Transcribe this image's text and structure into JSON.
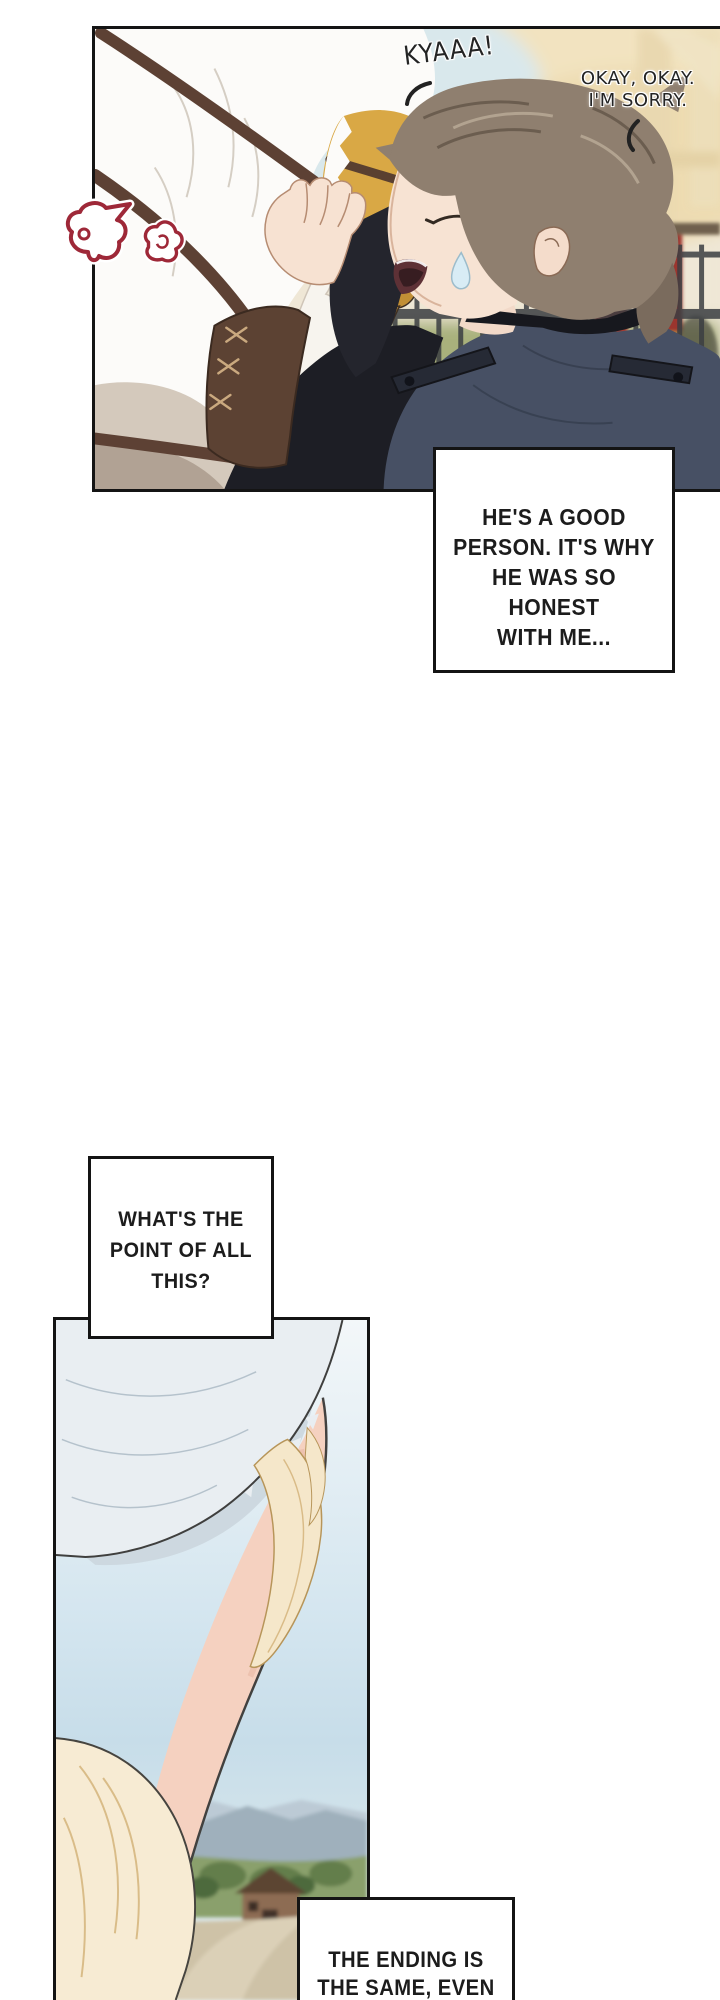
{
  "comic": {
    "panel1": {
      "sfx": "KYAAA!",
      "speech": {
        "line1": "OKAY, OKAY.",
        "line2": "I'M SORRY."
      },
      "narration": {
        "line1": "HE'S A GOOD",
        "line2": "PERSON. IT'S WHY",
        "line3": "HE WAS SO HONEST",
        "line4": "WITH ME..."
      }
    },
    "narration2": {
      "line1": "WHAT'S THE",
      "line2": "POINT OF ALL",
      "line3": "THIS?"
    },
    "narration3": {
      "line1": "THE ENDING IS",
      "line2": "THE SAME, EVEN"
    }
  },
  "icons": {
    "emote_left": "anger-puff-icon",
    "emote_right": "anger-puff-icon"
  },
  "colors": {
    "paper": "#ffffff",
    "ink": "#141414",
    "text": "#1c1c1c",
    "doodle_red": "#9e2838",
    "jacket_navy": "#475064",
    "beak_gold": "#d9a845",
    "banner_red": "#a33b33",
    "hat_blue_gray": "#e9eef2",
    "hair_cream": "#f5e7ca",
    "skin": "#f5d1c0",
    "grass_green": "#a9b17c",
    "sky_blue": "#d3e5ef"
  }
}
